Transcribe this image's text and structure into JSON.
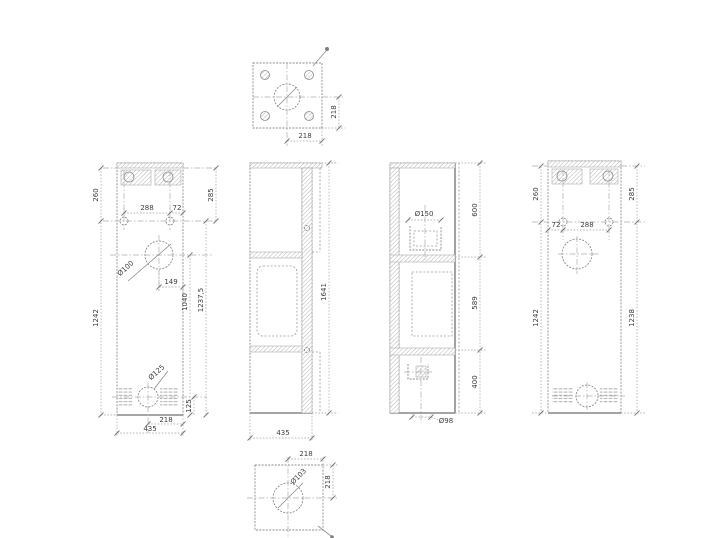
{
  "page": {
    "background": "#ffffff",
    "line_color": "#8c8c8c",
    "dim_line_color": "#a3a3a3",
    "text_color": "#3d3d3d"
  },
  "views": {
    "top": {
      "dim_width": "218",
      "dim_height": "218"
    },
    "rear": {
      "top_offset": "260",
      "hole_span": "288",
      "hole_edge": "72",
      "top_offset_right": "285",
      "top_hole_dia": "Ø100",
      "hole_x": "149",
      "height_left": "1242",
      "inner_height": "1040",
      "height_right": "1237,5",
      "bottom_hole_dia": "Ø125",
      "bottom_offset": "125",
      "half_width": "218",
      "width": "435"
    },
    "side_left": {
      "height": "1641",
      "depth": "435"
    },
    "side_right": {
      "flue_dia": "Ø150",
      "seg_top": "600",
      "seg_mid": "589",
      "seg_bottom": "400",
      "air_dia": "Ø98"
    },
    "front": {
      "top_offset": "260",
      "top_offset_right": "285",
      "hole_edge": "72",
      "hole_span": "288",
      "height_left": "1242",
      "height_right": "1238"
    },
    "bottom": {
      "dim_width": "218",
      "dim_height": "218",
      "hole_dia": "Ø103"
    }
  }
}
